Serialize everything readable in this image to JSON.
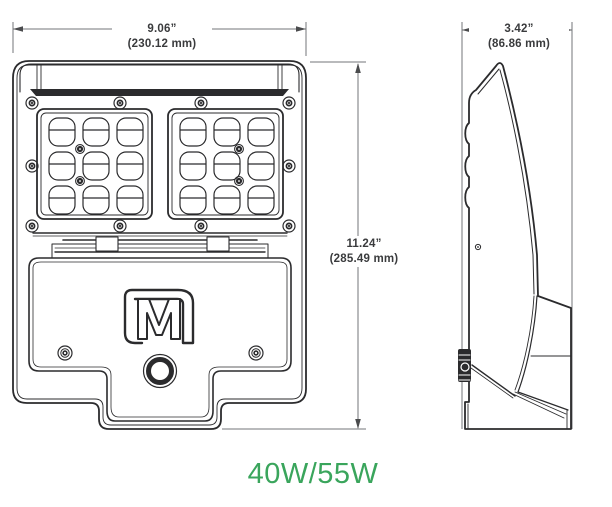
{
  "drawing": {
    "type": "luminaire-dimensional-drawing",
    "views": [
      "front",
      "side"
    ]
  },
  "dimensions": {
    "width_in": "9.06”",
    "width_mm": "(230.12 mm)",
    "height_in": "11.24”",
    "height_mm": "(285.49 mm)",
    "depth_in": "3.42”",
    "depth_mm": "(86.86 mm)"
  },
  "wattage_label": "40W/55W",
  "logo_letter": "M",
  "colors": {
    "accent_green": "#3aa55c",
    "line_dark": "#2b2b2d",
    "dim_gray": "#737578"
  }
}
